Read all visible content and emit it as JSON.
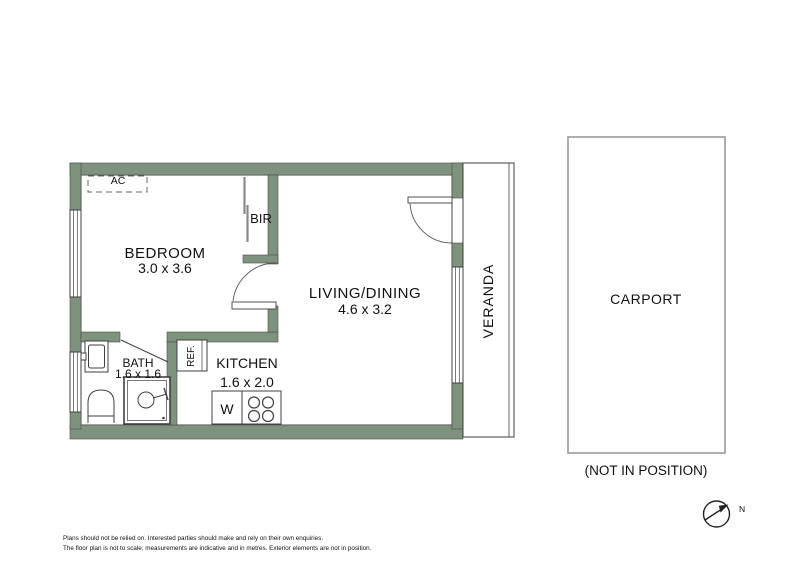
{
  "plan": {
    "rooms": {
      "bedroom": {
        "name": "BEDROOM",
        "dims": "3.0 x 3.6"
      },
      "living": {
        "name": "LIVING/DINING",
        "dims": "4.6 x 3.2"
      },
      "bath": {
        "name": "BATH",
        "dims": "1.6 x 1.6"
      },
      "kitchen": {
        "name": "KITCHEN",
        "dims": "1.6 x 2.0"
      },
      "veranda": {
        "name": "VERANDA"
      },
      "carport": {
        "name": "CARPORT",
        "note": "(NOT IN POSITION)"
      }
    },
    "fixtures": {
      "bir": "BIR",
      "ac": "AC",
      "fridge": "REF.",
      "washer": "W"
    },
    "compass": {
      "north_label": "N"
    },
    "colors": {
      "wall": "#7d937d",
      "outline": "#404040",
      "carport_border": "#9a9a9a"
    }
  },
  "footer": {
    "line1": "Plans should not be relied on. Interested parties should make and rely on their own enquiries.",
    "line2": "The floor plan is not to scale; measurements are indicative and in metres. Exterior elements are not in position."
  }
}
